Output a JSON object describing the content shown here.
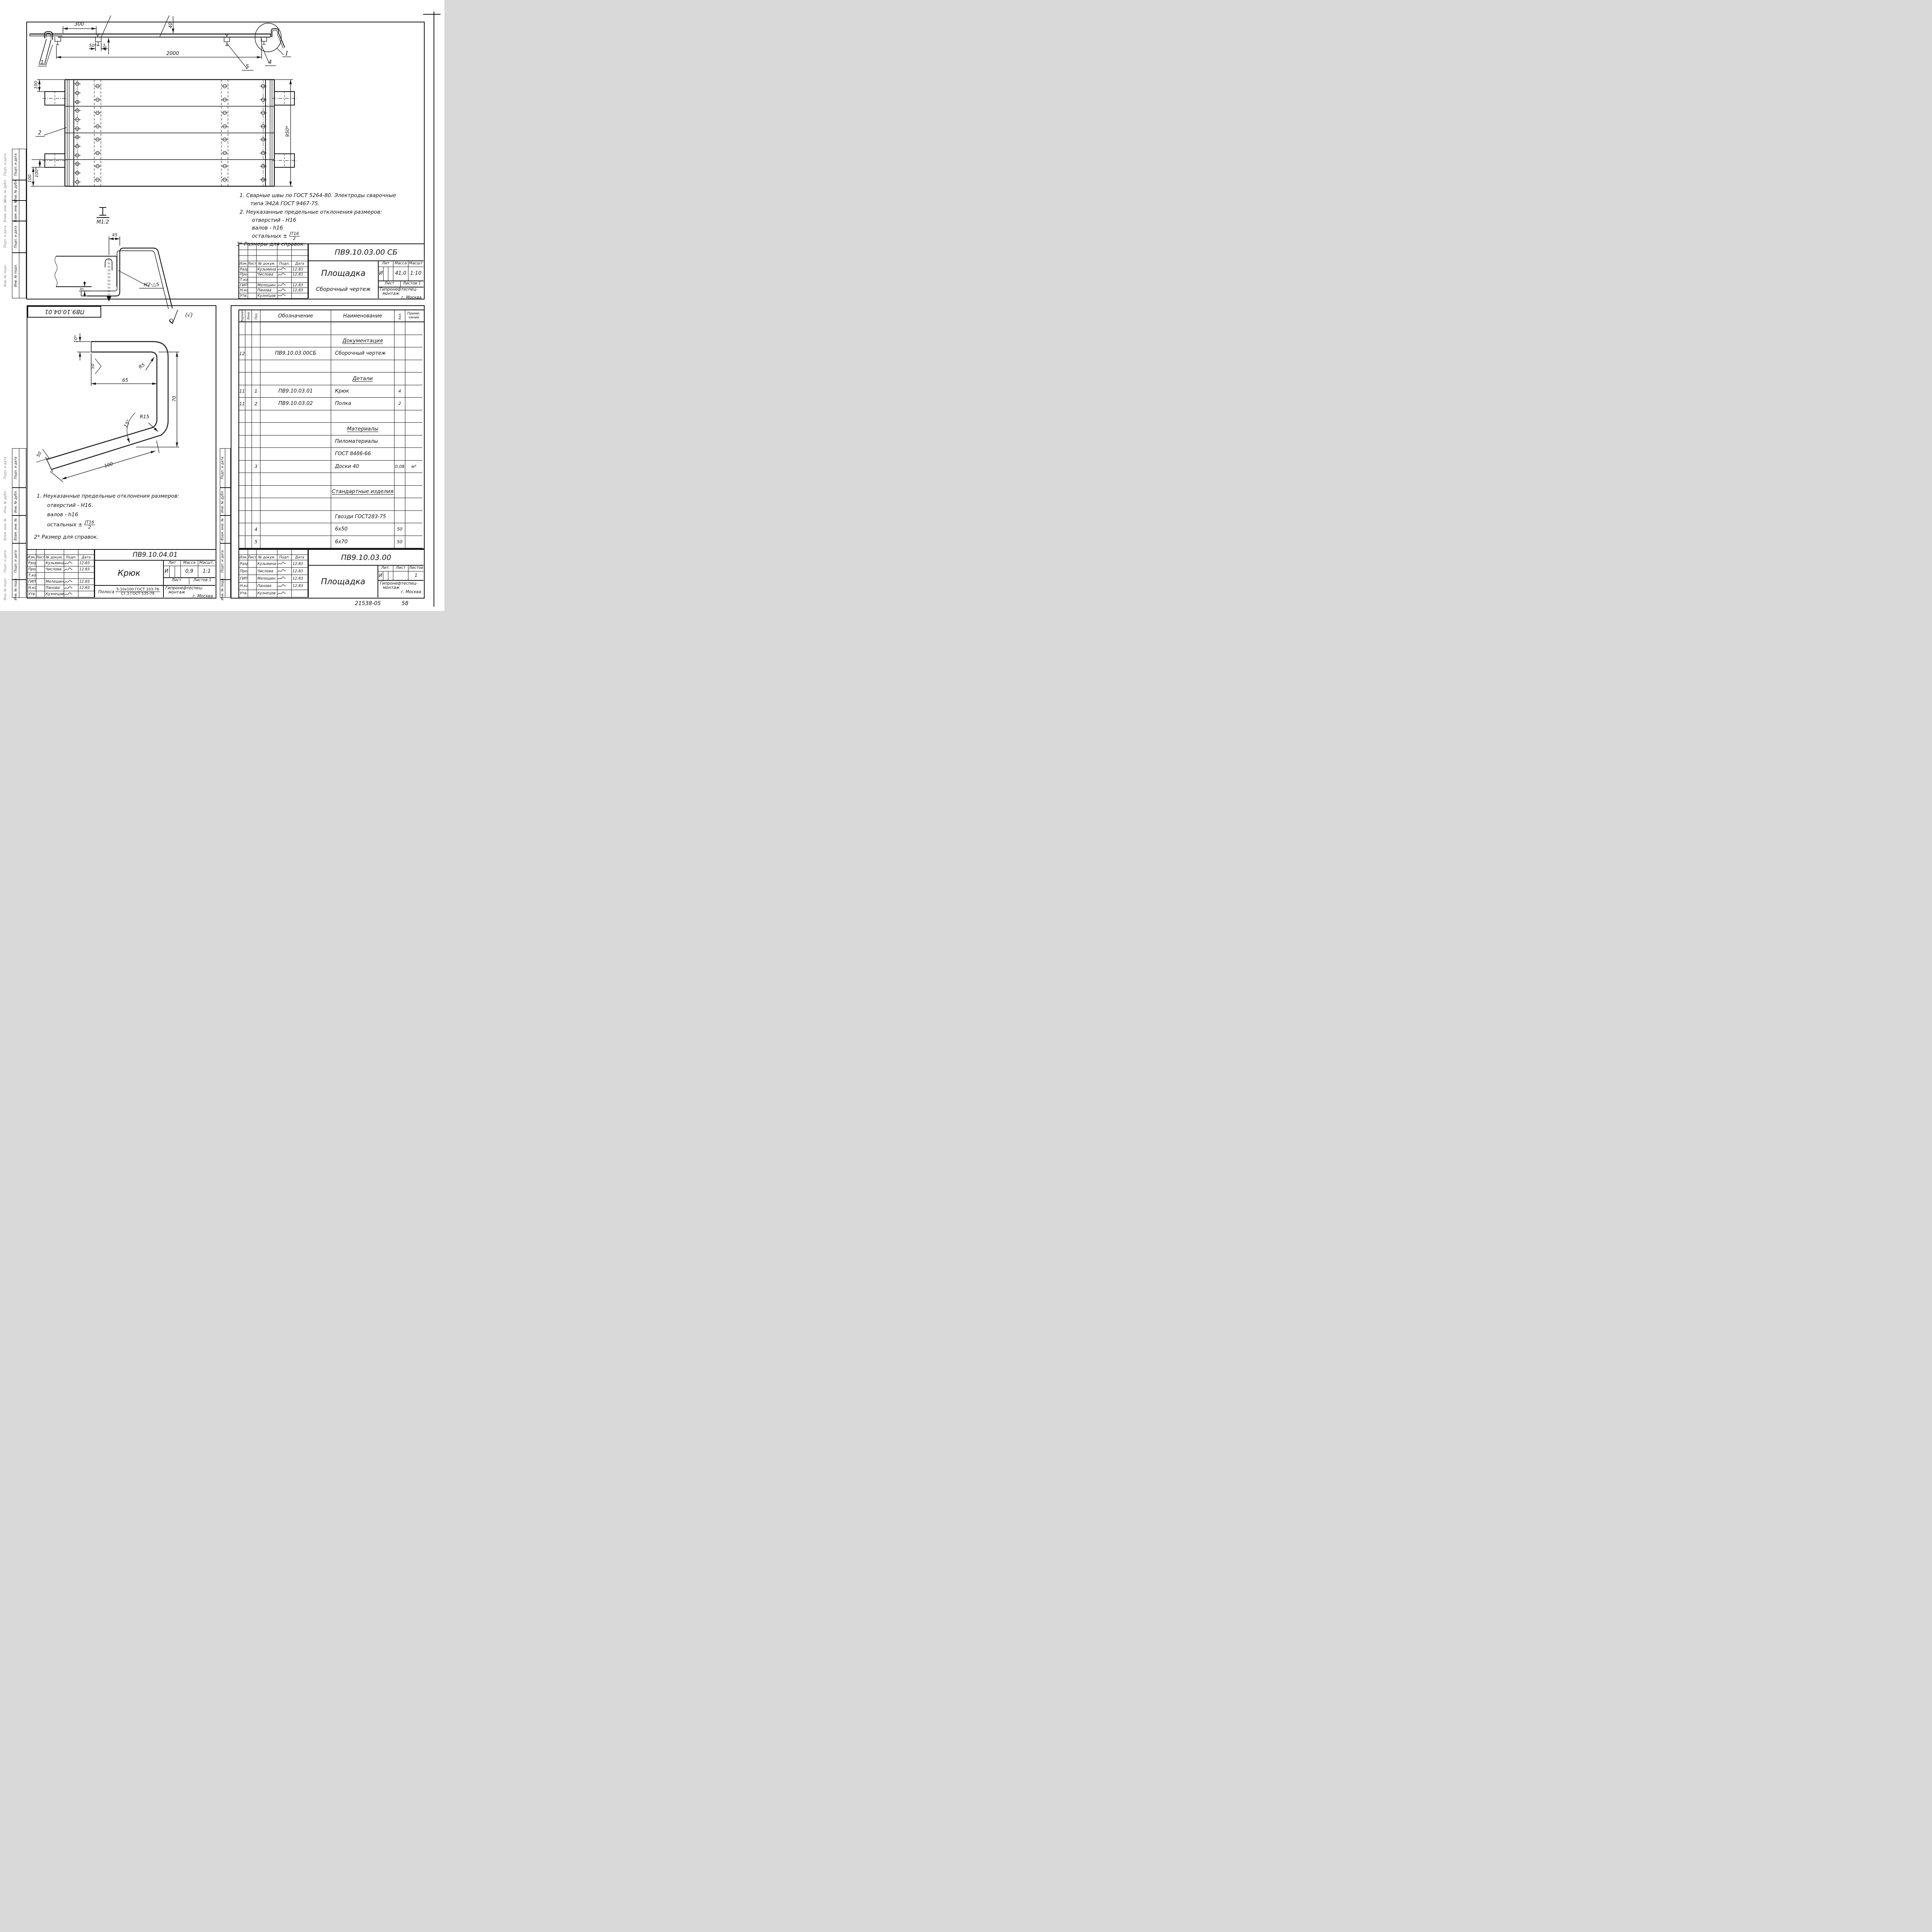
{
  "sidebar": {
    "labels": [
      "Подп. и дата",
      "Инв. № дубл.",
      "Взам. инв. №",
      "Подп. и дата",
      "Инв. № подл."
    ]
  },
  "tb_header": [
    "Изм.",
    "Лист",
    "№ докум.",
    "Подп.",
    "Дата"
  ],
  "org": {
    "l1": "Гипронефтеспец-",
    "l2": "монтаж",
    "l3": "г. Москва"
  },
  "sheet1": {
    "doc": "ПВ9.10.03.00 СБ",
    "name": "Площадка",
    "doctype": "Сборочный чертеж",
    "lit_label": "Лит",
    "mass_label": "Масса",
    "scale_label": "Масшт",
    "lit": "И",
    "mass": "41,0",
    "scale": "1:10",
    "sheet_label": "Лист",
    "sheets_label": "Листов 1",
    "rows": [
      {
        "role": "Разраб.",
        "name": "Кузьмина",
        "date": "12.83"
      },
      {
        "role": "Пров.",
        "name": "Числова",
        "date": "12.83"
      },
      {
        "role": "Т.контр.",
        "name": "",
        "date": ""
      },
      {
        "role": "ГИП",
        "name": "Мелешин",
        "date": "12.83"
      },
      {
        "role": "Н.контр.",
        "name": "Панова",
        "date": "12.83"
      },
      {
        "role": "Утв.",
        "name": "Кузнецов",
        "date": ""
      }
    ],
    "dims": {
      "d300": "300",
      "d50": "50*",
      "d40s": "40*",
      "d40t": "40'",
      "d2000": "2000",
      "pos1": "1",
      "pos5": "5",
      "pos4": "4",
      "detailI": "I",
      "p100t": "100",
      "p100s": "100*",
      "p100b": "100",
      "p950": "950*",
      "pos2": "2",
      "secI": "I",
      "sec_scale": "М1:2",
      "d45": "45",
      "d5": "5",
      "weld": "Н2-△5"
    },
    "notes": [
      "1. Сварные швы по ГОСТ 5264-80. Электроды сварочные",
      "типа  Э42А ГОСТ 9467-75.",
      "2. Неуказанные предельные отклонения размеров:",
      "отверстий - Н16",
      "валов - h16",
      "остальных ±",
      "3* Размеры для справок."
    ],
    "frac": {
      "num": "JT16",
      "den": "2"
    }
  },
  "sheet2": {
    "doc": "ПВ9.10.04.01",
    "stamp": "ПВ9.10.04.01",
    "name": "Крюк",
    "rough": "(√)",
    "lit_label": "Лит",
    "mass_label": "Масса",
    "scale_label": "Масшт.",
    "lit": "И",
    "mass": "0,9",
    "scale": "1:1",
    "sheet_label": "Лист",
    "sheets_label": "Листов 1",
    "material": {
      "prefix": "Полоса",
      "num": "5-10х100 ГОСТ 103-76",
      "den": "Ст.3 ГОСТ 535-79"
    },
    "rows": [
      {
        "role": "Разраб.",
        "name": "Кузьмина",
        "date": "12.83"
      },
      {
        "role": "Пров.",
        "name": "Числова",
        "date": "12.83"
      },
      {
        "role": "Т.контр.",
        "name": "",
        "date": ""
      },
      {
        "role": "ГИП",
        "name": "Мелешин",
        "date": "12.83"
      },
      {
        "role": "Н.контр.",
        "name": "Панова",
        "date": "12.83"
      },
      {
        "role": "Утв.",
        "name": "Кузнецов",
        "date": ""
      }
    ],
    "dims": {
      "d10": "10*",
      "d50t": "50",
      "d65": "65",
      "r5": "R5",
      "d70": "70",
      "a15": "15°",
      "r15": "R15",
      "d100": "100",
      "d50b": "50"
    },
    "notes": [
      "1. Неуказанные предельные отклонения размеров:",
      "отверстий - Н16.",
      "валов - h16",
      "остальных ±",
      "2* Размер для справок."
    ],
    "frac": {
      "num": "JT16",
      "den": "2"
    }
  },
  "sheet3": {
    "doc": "ПВ9.10.03.00",
    "name": "Площадка",
    "lit_label": "Лит.",
    "sheet_label": "Лист",
    "sheets_label": "Листов",
    "lit": "И",
    "sheets_val": "1",
    "rows": [
      {
        "role": "Разраб.",
        "name": "Кузьмина",
        "date": "12.83"
      },
      {
        "role": "Пров.",
        "name": "Числова",
        "date": "12.83"
      },
      {
        "role": "ГИП",
        "name": "Мелешин",
        "date": "12.83"
      },
      {
        "role": "Н.контр",
        "name": "Панова",
        "date": "12.83"
      },
      {
        "role": "Утв.",
        "name": "Кузнецов",
        "date": ""
      }
    ],
    "spec": {
      "headers": [
        "Формат",
        "Зона",
        "Поз.",
        "Обозначение",
        "Наименование",
        "Кол."
      ],
      "note1": "Приме-",
      "note2": "чание",
      "rows": [
        {},
        {
          "n": "Документация",
          "s": true
        },
        {
          "f": "12",
          "r": "ПВ9.10.03.00СБ",
          "n": "Сборочный чертеж",
          "pl": true
        },
        {},
        {
          "n": "Детали",
          "s": true
        },
        {
          "f": "11",
          "p": "1",
          "r": "ПВ9.10.03.01",
          "n": "Крюк",
          "q": "4",
          "pl": true
        },
        {
          "f": "11",
          "p": "2",
          "r": "ПВ9.10.03.02",
          "n": "Полка",
          "q": "2",
          "pl": true
        },
        {},
        {
          "n": "Материалы",
          "s": true
        },
        {
          "n": "Пиломатериалы",
          "pl": true
        },
        {
          "n": "ГОСТ 8486-66",
          "pl": true
        },
        {
          "p": "3",
          "n": "Доски 40",
          "q": "0,08",
          "o": "м³",
          "pl": true
        },
        {},
        {
          "n": "Стандартные изделия",
          "s": true
        },
        {},
        {
          "n": "Гвозди ГОСТ283-75",
          "pl": true
        },
        {
          "p": "4",
          "n": "6х50",
          "q": "50",
          "pl": true
        },
        {
          "p": "5",
          "n": "6х70",
          "q": "50",
          "pl": true
        }
      ]
    },
    "anno1": "21538-05",
    "anno2": "58"
  }
}
